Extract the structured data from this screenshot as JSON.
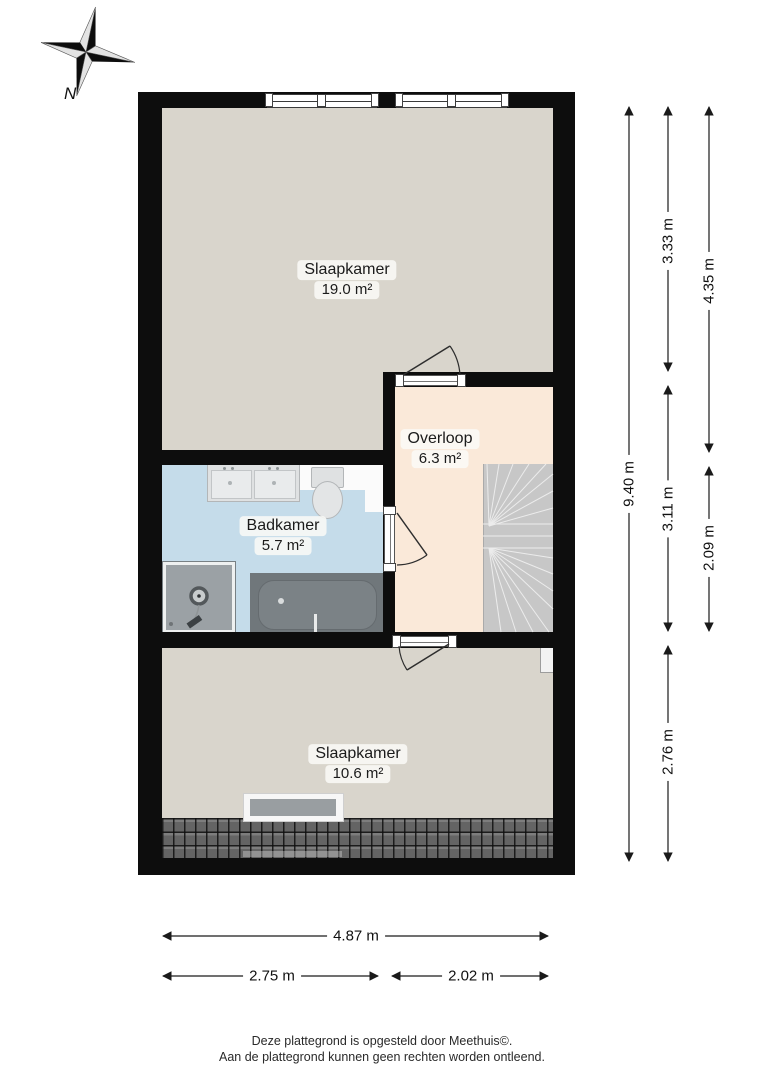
{
  "compass": {
    "label": "N"
  },
  "rooms": {
    "bedroom_large": {
      "name": "Slaapkamer",
      "area": "19.0 m²"
    },
    "landing": {
      "name": "Overloop",
      "area": "6.3 m²"
    },
    "bathroom": {
      "name": "Badkamer",
      "area": "5.7 m²"
    },
    "bedroom_small": {
      "name": "Slaapkamer",
      "area": "10.6 m²"
    }
  },
  "dimensions": {
    "total_height": "9.40 m",
    "height_segments_inner": [
      "3.33 m",
      "3.11 m",
      "2.76 m"
    ],
    "height_segments_outer": [
      "4.35 m",
      "2.09 m"
    ],
    "total_width": "4.87 m",
    "width_segments": [
      "2.75 m",
      "2.02 m"
    ]
  },
  "footer": {
    "line1": "Deze plattegrond is opgesteld door Meethuis©.",
    "line2": "Aan de plattegrond kunnen geen rechten worden ontleend."
  },
  "colors": {
    "wall": "#0d0d0d",
    "floor_bedroom": "#d9d5cc",
    "floor_landing": "#fae9d9",
    "floor_bathroom": "#c5dcea",
    "stairs": "#c7c7c7",
    "roof_tiles": "#646464"
  }
}
